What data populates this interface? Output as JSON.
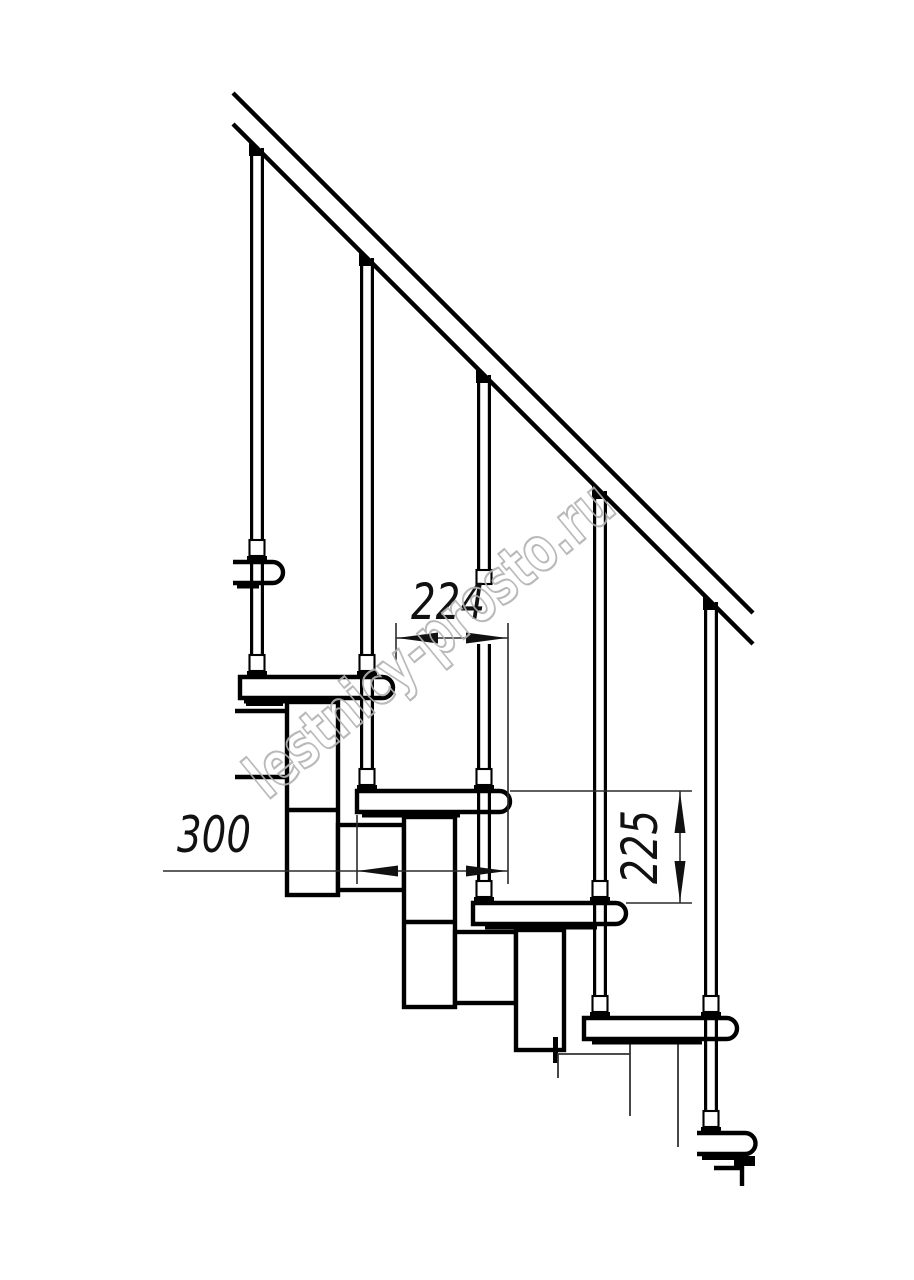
{
  "drawing": {
    "watermark": "lestnicy-prosto.ru",
    "dimension_labels": {
      "step_run": "224",
      "tread_depth": "300",
      "step_rise": "225"
    },
    "colors": {
      "background": "#ffffff",
      "line": "#000000",
      "dimension_line": "#2b2b2b",
      "dimension_text": "#111111",
      "watermark_outline": "#b2b2b2"
    }
  }
}
